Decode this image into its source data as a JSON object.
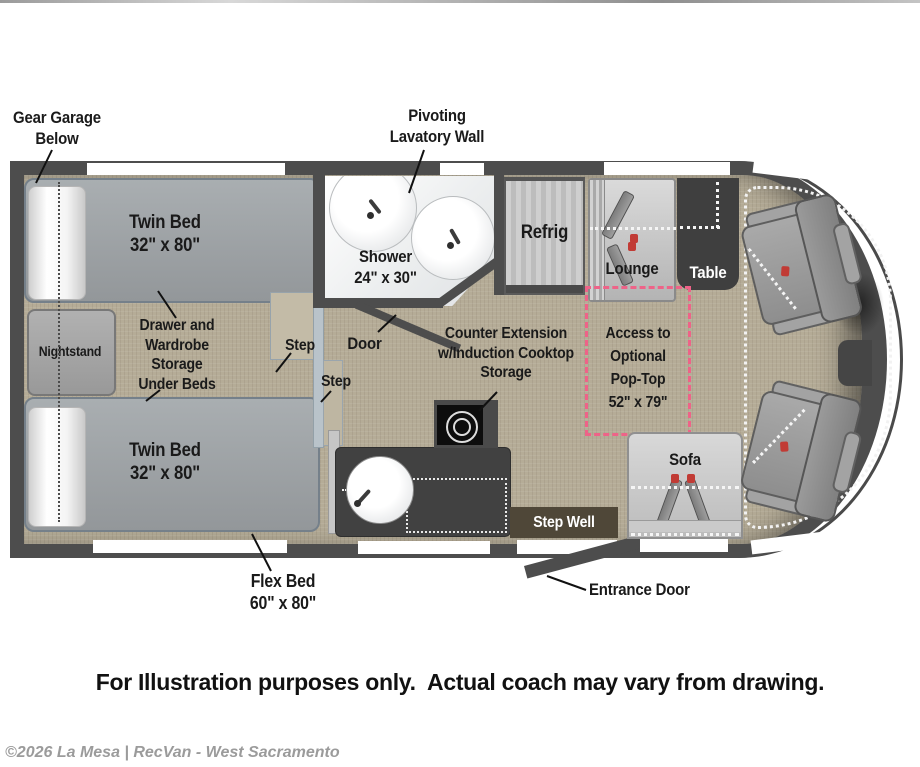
{
  "colors": {
    "wall": "#4d4d4d",
    "floor": "#b5ac97",
    "bed": "#9aa0a4",
    "counter": "#414141",
    "table": "#3f3f3f",
    "step_well_bg": "#4f4738",
    "pop_top_dash": "#ee6388",
    "text": "#1a1a1a",
    "watermark": "#9b9b9b"
  },
  "floorplan": {
    "labels": {
      "gear_garage": [
        "Gear Garage",
        "Below"
      ],
      "pivoting_lavatory": [
        "Pivoting",
        "Lavatory Wall"
      ],
      "twin_bed_upper": [
        "Twin Bed",
        "32\" x 80\""
      ],
      "twin_bed_lower": [
        "Twin Bed",
        "32\" x 80\""
      ],
      "nightstand": "Nightstand",
      "under_bed_storage": [
        "Drawer and",
        "Wardrobe Storage",
        "Under Beds"
      ],
      "step_upper": "Step",
      "step_lower": "Step",
      "shower": [
        "Shower",
        "24\" x 30\""
      ],
      "door": "Door",
      "refrig": "Refrig",
      "lounge": "Lounge",
      "table": "Table",
      "pop_top": [
        "Access to",
        "Optional",
        "Pop-Top",
        "52\" x 79\""
      ],
      "counter_extension": [
        "Counter Extension",
        "w/Induction Cooktop",
        "Storage"
      ],
      "step_well": "Step Well",
      "sofa": "Sofa",
      "entrance_door": "Entrance Door",
      "flex_bed": [
        "Flex Bed",
        "60\" x 80\""
      ]
    }
  },
  "footer": {
    "disclaimer": "For Illustration purposes only.  Actual coach may vary from drawing.",
    "watermark": "©2026 La Mesa | RecVan - West Sacramento"
  }
}
